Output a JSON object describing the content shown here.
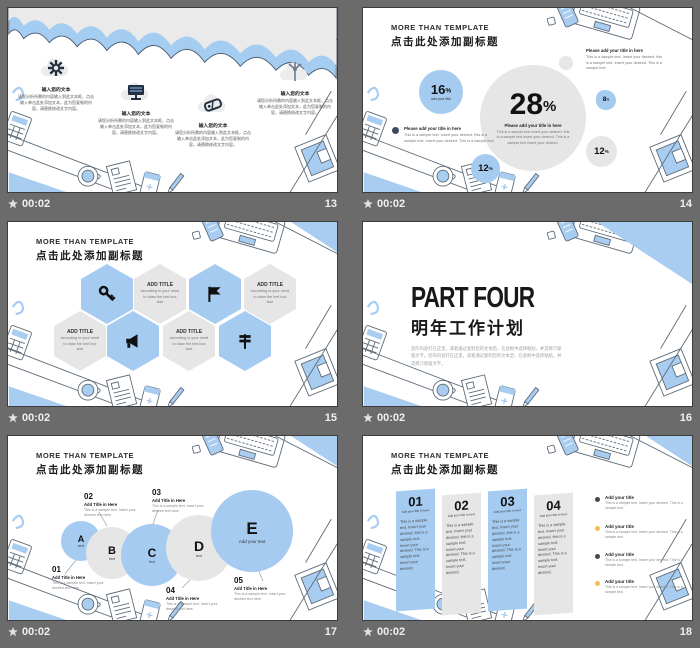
{
  "app": {
    "name": "powerpoint-slide-sorter",
    "background_color": "#6B6B6B"
  },
  "colors": {
    "accent_blue": "#A5CBF0",
    "light_gray": "#E6E6E6",
    "dark_text": "#222222",
    "meta_text": "#F0F0F0",
    "bullet_dark": "#4A4A4A",
    "bullet_yellow": "#F2C14E",
    "doodle_outline": "#5D6B78",
    "cloud_gray": "#EAEAEA"
  },
  "slides": [
    {
      "number": "13",
      "time": "00:02",
      "items": [
        {
          "icon": "gear-icon",
          "title": "输入您的文本",
          "body": "请您分析所需的内容输入到此文本框，点击输入单击此处添加文本，此为您复制的内容，请替换修改文字内容。"
        },
        {
          "icon": "monitor-icon",
          "title": "输入您的文本",
          "body": "请您分析所需的内容输入到此文本框，点击输入单击此处添加文本，此为您复制的内容，请替换修改文字内容。"
        },
        {
          "icon": "tag-icon",
          "title": "输入您的文本",
          "body": "请您分析所需的内容输入到此文本框，点击输入单击此处添加文本，此为您复制的内容，请替换修改文字内容。"
        },
        {
          "icon": "wind-turbine-icon",
          "title": "输入您的文本",
          "body": "请您分析所需的内容输入到此文本框，点击输入单击此处添加文本，此为您复制的内容，请替换修改文字内容。"
        }
      ]
    },
    {
      "number": "14",
      "time": "00:02",
      "title": "MORE THAN TEMPLATE",
      "subtitle": "点击此处添加副标题",
      "stats": {
        "s16": {
          "value": "16",
          "unit": "%",
          "label": "add your title"
        },
        "s28": {
          "value": "28",
          "unit": "%",
          "heading": "Please add your title in here",
          "body": "This is a sample text insert your desired. this is a sample text insert your desired. This is a sample text insert your desired."
        },
        "s8": {
          "value": "8",
          "unit": "%"
        },
        "s12gray": {
          "value": "12",
          "unit": "%"
        },
        "s12blue": {
          "value": "12",
          "unit": "%"
        }
      },
      "right_block": {
        "heading": "Please add your title in here",
        "body": "This is a sample text. Insert your desired. this is a sample text. Insert your desired. This is a sample text."
      },
      "left_block": {
        "heading": "Please add your title in here",
        "body": "This is a sample text. Insert your desired. this is a sample text. Insert your desired. This is a sample text."
      }
    },
    {
      "number": "15",
      "time": "00:02",
      "title": "MORE THAN TEMPLATE",
      "subtitle": "点击此处添加副标题",
      "hexes": [
        {
          "type": "icon",
          "icon": "key-icon"
        },
        {
          "type": "text",
          "title": "ADD TITLE",
          "body": "according to your need to draw the text box size"
        },
        {
          "type": "icon",
          "icon": "flag-icon"
        },
        {
          "type": "text",
          "title": "ADD TITLE",
          "body": "according to your need to draw the text box size"
        },
        {
          "type": "text",
          "title": "ADD TITLE",
          "body": "according to your need to draw the text box size"
        },
        {
          "type": "icon",
          "icon": "megaphone-icon"
        },
        {
          "type": "text",
          "title": "ADD TITLE",
          "body": "according to your need to draw the text box size"
        },
        {
          "type": "icon",
          "icon": "signpost-icon"
        }
      ]
    },
    {
      "number": "16",
      "time": "00:02",
      "part": "PART FOUR",
      "heading": "明年工作计划",
      "body": "您的内容打在这里，或者通过复制您的文本后，在此框中选择粘贴，并选择只保留文字。您的内容打在这里，或者通过复制您的文本后，在此框中选择粘贴，并选择只保留文字。"
    },
    {
      "number": "17",
      "time": "00:02",
      "title": "MORE THAN TEMPLATE",
      "subtitle": "点击此处添加副标题",
      "steps": [
        {
          "num": "01",
          "label": "Add Title in Here",
          "body": "This is a sample text. Insert your desired text here.",
          "letter": "A",
          "circle_label": "text"
        },
        {
          "num": "02",
          "label": "Add Title in Here",
          "body": "This is a sample text. Insert your desired text here.",
          "letter": "B",
          "circle_label": "text"
        },
        {
          "num": "03",
          "label": "Add Title in Here",
          "body": "This is a sample text. Insert your desired text here.",
          "letter": "C",
          "circle_label": "text"
        },
        {
          "num": "04",
          "label": "Add Title in Here",
          "body": "This is a sample text. Insert your desired text here.",
          "letter": "D",
          "circle_label": "text"
        },
        {
          "num": "05",
          "label": "Add Title in Here",
          "body": "This is a sample text. Insert your desired text here.",
          "letter": "E",
          "circle_label": "Add your text"
        }
      ]
    },
    {
      "number": "18",
      "time": "00:02",
      "title": "MORE THAN TEMPLATE",
      "subtitle": "点击此处添加副标题",
      "columns": [
        {
          "num": "01",
          "sub": "Add your title in here",
          "body": "This is a sample text. Insert your desired. this is a sample text. Insert your desired. This is a sample text. Insert your desired."
        },
        {
          "num": "02",
          "sub": "Add your title in here",
          "body": "This is a sample text. Insert your desired. this is a sample text. Insert your desired. This is a sample text. Insert your desired."
        },
        {
          "num": "03",
          "sub": "Add your title in here",
          "body": "This is a sample text. Insert your desired. this is a sample text. Insert your desired. This is a sample text. Insert your desired."
        },
        {
          "num": "04",
          "sub": "Add your title in here",
          "body": "This is a sample text. Insert your desired. this is a sample text. Insert your desired. This is a sample text. Insert your desired."
        }
      ],
      "bullets": [
        {
          "label": "Add your title",
          "body": "This is a sample text. Insert your desired. This is a sample text."
        },
        {
          "label": "Add your title",
          "body": "This is a sample text. Insert your desired. This is a sample text."
        },
        {
          "label": "Add your title",
          "body": "This is a sample text. Insert your desired. This is a sample text."
        },
        {
          "label": "Add your title",
          "body": "This is a sample text. Insert your desired. This is a sample text."
        }
      ]
    }
  ]
}
